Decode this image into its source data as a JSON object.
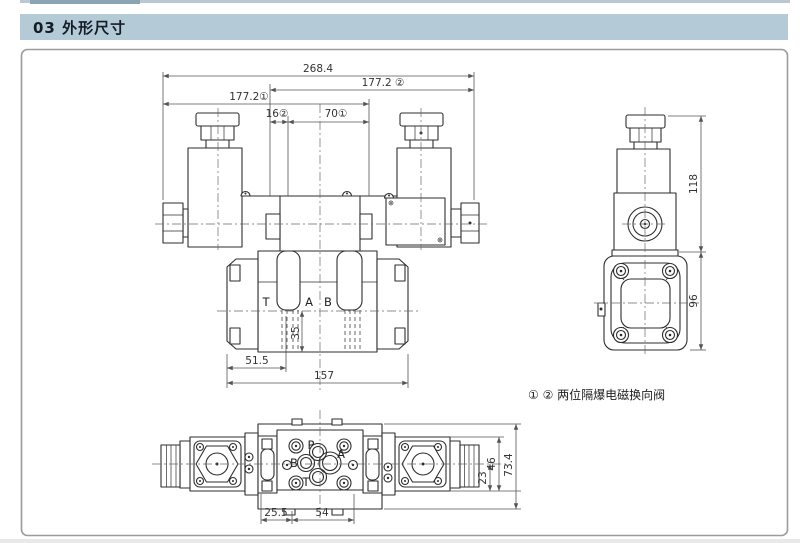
{
  "header": {
    "label": "03 外形尺寸"
  },
  "colors": {
    "header_bg": "#b5cad7",
    "top_strip": "#b9c8d2",
    "top_strip_accent": "#8aa4b4",
    "frame_border": "#9b9b9b",
    "line": "#2e2e2e",
    "dim_line": "#555555"
  },
  "front_view": {
    "dims": {
      "overall_width": "268.4",
      "width_to_right": "177.2 ②",
      "width_to_left": "177.2①",
      "screw_offset": "16②",
      "screw_spacing": "70①",
      "port_offset": "51.5",
      "base_width": "157",
      "base_depth": "35"
    },
    "port_labels": {
      "t": "T",
      "a": "A",
      "b": "B"
    }
  },
  "side_view": {
    "dims": {
      "upper_height": "118",
      "lower_height": "96"
    }
  },
  "bottom_view": {
    "dims": {
      "edge_offset": "25.5",
      "hole_spacing": "54",
      "center_to_bottom": "23",
      "body_height": "46",
      "overall_height": "73.4"
    },
    "port_labels": {
      "p": "P",
      "a": "A",
      "b": "B",
      "t": "T"
    }
  },
  "note": {
    "text": "① ② 两位隔爆电磁换向阀"
  }
}
